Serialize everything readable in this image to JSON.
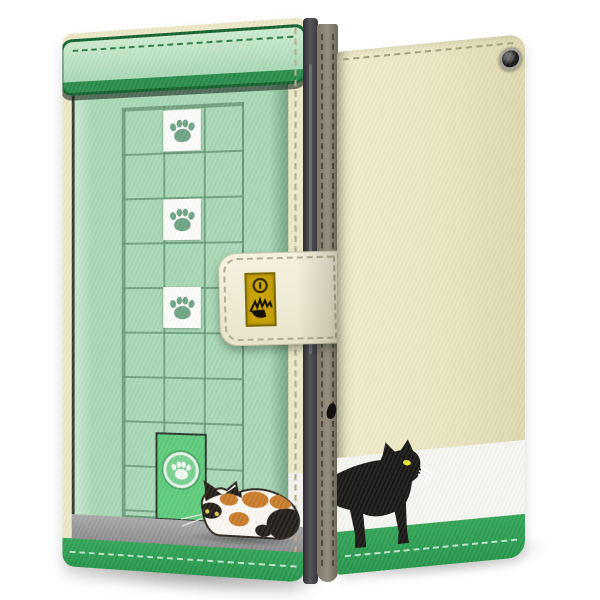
{
  "page": {
    "background_color": "#ffffff",
    "description": "Product render of a cat-themed flip wallet smartphone case, front closed view and back view"
  },
  "front_case": {
    "label": "Front of closed wallet case with greenhouse cat-door design",
    "colors": {
      "body_green": "#a8d8b5",
      "awning_fill": "#b7e0c4",
      "awning_border": "#15622f",
      "awning_lip": "#2a8c4b",
      "lattice_line": "#649673",
      "paw_tile": "#fcfdfb",
      "paw_print": "#6fa486",
      "cat_door_green": "#5ecb7c",
      "door_ring": "#e7f6ea",
      "threshold_gray": "#9b9b9d",
      "bottom_band_green": "#2f9e53",
      "edge_cream": "#ece8c6"
    },
    "lattice": {
      "columns": 3,
      "rows": 9
    },
    "paw_tiles": {
      "count": 3,
      "icon": "paw-print-icon"
    },
    "cat_door": {
      "label": "cat door with paw emblem",
      "icon": "paw-print-icon"
    },
    "calico_cat": {
      "description": "Calico cat crouching in front of the cat door, facing left",
      "colors": {
        "fur_white": "#fbf8f2",
        "fur_orange": "#c87c2b",
        "fur_black": "#241e19",
        "eye": "#d8cf46"
      }
    },
    "clasp": {
      "label": "magnetic clasp strap",
      "strap_color": "#f2eedb",
      "plate_color": "#c9a40c",
      "button_icon": "snap-button-icon",
      "emblem_icon": "black-cat-doodle-icon"
    }
  },
  "back_case": {
    "label": "Back of wallet case with walking black cat",
    "colors": {
      "body_ivory": "#eae6c0",
      "white_band": "#f5f5f2",
      "green_band": "#2f9e53"
    },
    "camera_hole": {
      "label": "camera opening",
      "icon": "camera-hole-icon"
    },
    "black_cat": {
      "description": "Black cat silhouette walking to the right along the green band",
      "colors": {
        "fur": "#1a1816",
        "eye": "#e4e63a",
        "whiskers": "#ffffff"
      }
    }
  },
  "hardware": {
    "spine_color": "#8d8575",
    "phone_edge_color": "#3c3b40",
    "stitching_color": "#b4ad92"
  }
}
